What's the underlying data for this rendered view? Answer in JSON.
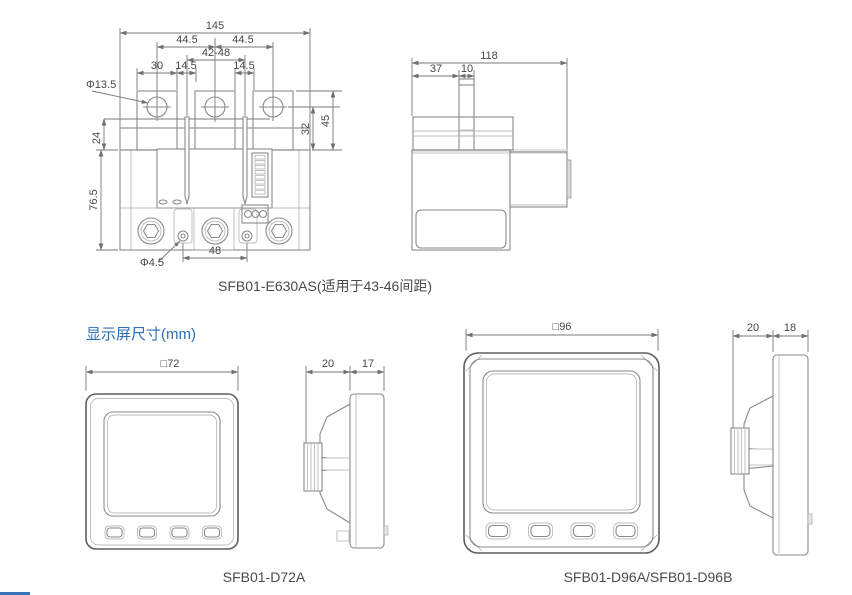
{
  "section": {
    "heading": "显示屏尺寸(mm)",
    "accent_color": "#2c6fb7",
    "line_color": "#8a8a8a"
  },
  "relay_front": {
    "caption": "SFB01-E630AS(适用于43-46间距)",
    "dim_overall_width": "145",
    "dim_pitch_left": "44.5",
    "dim_pitch_right": "44.5",
    "dim_busbar_range": "42-48",
    "dim_tab_width": "30",
    "dim_gap_left": "14.5",
    "dim_gap_right": "14.5",
    "dim_hole_diameter": "Φ13.5",
    "dim_24": "24",
    "dim_32": "32",
    "dim_45": "45",
    "dim_body_height": "76.5",
    "dim_screw_diameter": "Φ4.5",
    "dim_screw_spacing": "48"
  },
  "relay_side": {
    "dim_overall_depth": "118",
    "dim_37": "37",
    "dim_10": "10"
  },
  "display_d72": {
    "caption": "SFB01-D72A",
    "dim_front": "□72",
    "dim_depth_rear": "20",
    "dim_depth_front": "17"
  },
  "display_d96": {
    "caption": "SFB01-D96A/SFB01-D96B",
    "dim_front": "□96",
    "dim_depth_rear": "20",
    "dim_depth_front": "18"
  }
}
